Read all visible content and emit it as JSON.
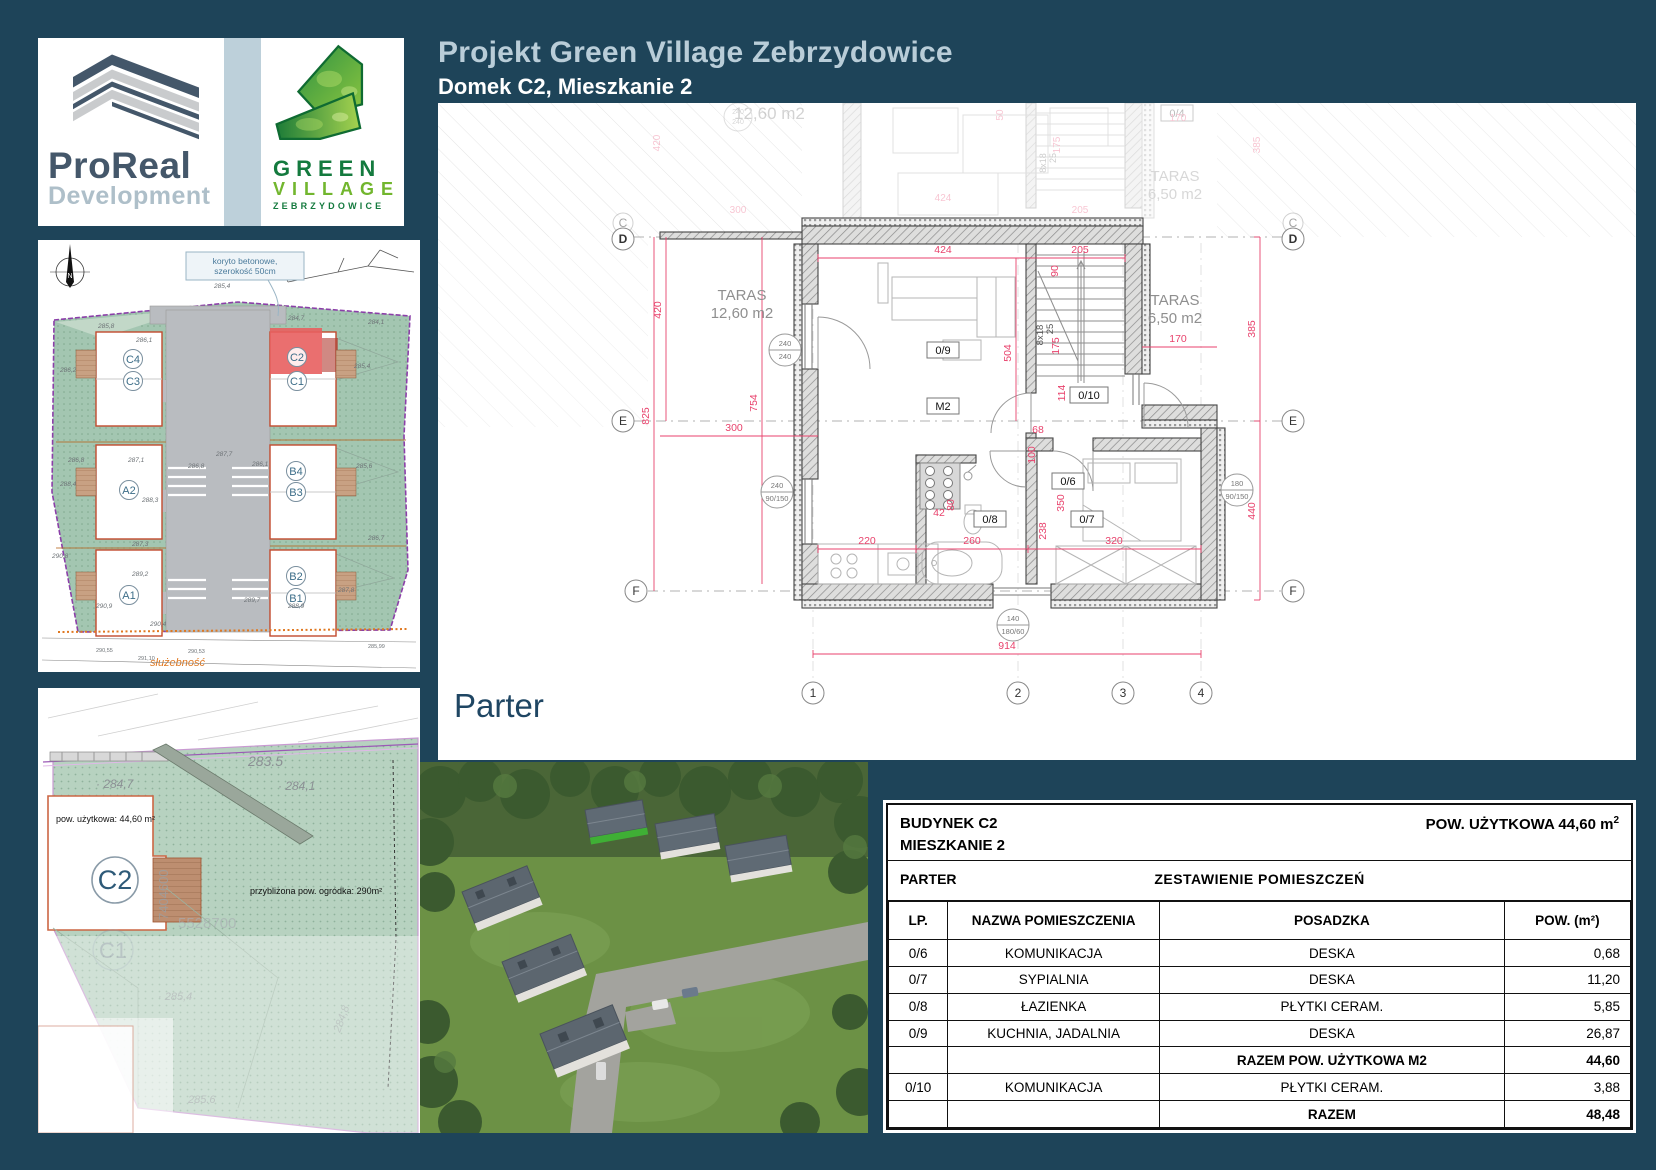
{
  "header": {
    "title": "Projekt Green Village Zebrzydowice",
    "subtitle": "Domek C2, Mieszkanie 2"
  },
  "logos": {
    "proreal": {
      "name": "ProReal",
      "sub": "Development"
    },
    "green_village": {
      "l1": "GREEN",
      "l2": "VILLAGE",
      "l3": "ZEBRZYDOWICE"
    }
  },
  "site_plan": {
    "north": "N",
    "note1": "koryto betonowe,",
    "note2": "szerokość 50cm",
    "easement": "służebność",
    "units": {
      "c4": "C4",
      "c3": "C3",
      "c2": "C2",
      "c1": "C1",
      "a2": "A2",
      "a1": "A1",
      "b4": "B4",
      "b3": "B3",
      "b2": "B2",
      "b1": "B1"
    },
    "elev": [
      "285,1",
      "285,4",
      "285,8",
      "284,7",
      "284,1",
      "286,1",
      "286,2",
      "286,8",
      "287,1",
      "287,3",
      "287,7",
      "288,3",
      "288,4",
      "289,2",
      "288,9",
      "289,7",
      "290,4",
      "290,8",
      "290,9",
      "287,8",
      "286,7",
      "285,6"
    ],
    "survey": [
      "290,55",
      "291,10",
      "290,53",
      "285,99"
    ]
  },
  "garden_plan": {
    "usable_area": "pow. użytkowa: 44,60 m²",
    "garden_area": "przybliżona pow. ogródka: 290m²",
    "unit": "C2",
    "unit_faded": "C1",
    "coord_v": "7404600",
    "coord_h": "5528700",
    "elev": [
      "283.5",
      "· 284,7",
      "· 284,1",
      "· 285,4",
      "284,8",
      "285.6"
    ]
  },
  "floor_plan": {
    "level": "Parter",
    "rooms": {
      "r04": "0/4",
      "r06": "0/6",
      "r07": "0/7",
      "r08": "0/8",
      "r09": "0/9",
      "r10": "0/10",
      "m2": "M2"
    },
    "taras_l1": "TARAS",
    "taras_l2": "12,60 m2",
    "taras_r1": "TARAS",
    "taras_r2": "6,50 m2",
    "ghost_area": "12,60 m2",
    "stairs1": "8x18",
    "stairs2": "25",
    "grid": {
      "c": "C",
      "d": "D",
      "e": "E",
      "f": "F",
      "n1": "1",
      "n2": "2",
      "n3": "3",
      "n4": "4"
    },
    "dims": {
      "d300": "300",
      "d420": "420",
      "d825": "825",
      "d754": "754",
      "d424": "424",
      "d205": "205",
      "d90": "90",
      "d504": "504",
      "d175": "175",
      "d114": "114",
      "d170": "170",
      "d385": "385",
      "d68": "68",
      "d100": "100",
      "d350": "350",
      "d238": "238",
      "d80": "80",
      "d42": "42",
      "d220": "220",
      "d260": "260",
      "d320": "320",
      "d914": "914",
      "d440": "440",
      "d50": "50"
    },
    "win": {
      "w1a": "240",
      "w1b": "240",
      "w2a": "240",
      "w2b": "90/150",
      "w3a": "140",
      "w3b": "180/60",
      "w4a": "180",
      "w4b": "90/150"
    }
  },
  "table": {
    "building": "BUDYNEK C2",
    "apartment": "MIESZKANIE 2",
    "area_label": "POW. UŻYTKOWA 44,60 m",
    "area_sup": "2",
    "level": "PARTER",
    "title": "ZESTAWIENIE POMIESZCZEŃ",
    "col_lp": "LP.",
    "col_name": "NAZWA POMIESZCZENIA",
    "col_floor": "POSADZKA",
    "col_area": "POW. (m²)",
    "rows": [
      {
        "lp": "0/6",
        "name": "KOMUNIKACJA",
        "floor": "DESKA",
        "area": "0,68"
      },
      {
        "lp": "0/7",
        "name": "SYPIALNIA",
        "floor": "DESKA",
        "area": "11,20"
      },
      {
        "lp": "0/8",
        "name": "ŁAZIENKA",
        "floor": "PŁYTKI CERAM.",
        "area": "5,85"
      },
      {
        "lp": "0/9",
        "name": "KUCHNIA, JADALNIA",
        "floor": "DESKA",
        "area": "26,87"
      },
      {
        "lp": "",
        "name": "",
        "floor": "RAZEM POW. UŻYTKOWA M2",
        "area": "44,60"
      },
      {
        "lp": "0/10",
        "name": "KOMUNIKACJA",
        "floor": "PŁYTKI CERAM.",
        "area": "3,88"
      },
      {
        "lp": "",
        "name": "",
        "floor": "RAZEM",
        "area": "48,48"
      }
    ]
  }
}
